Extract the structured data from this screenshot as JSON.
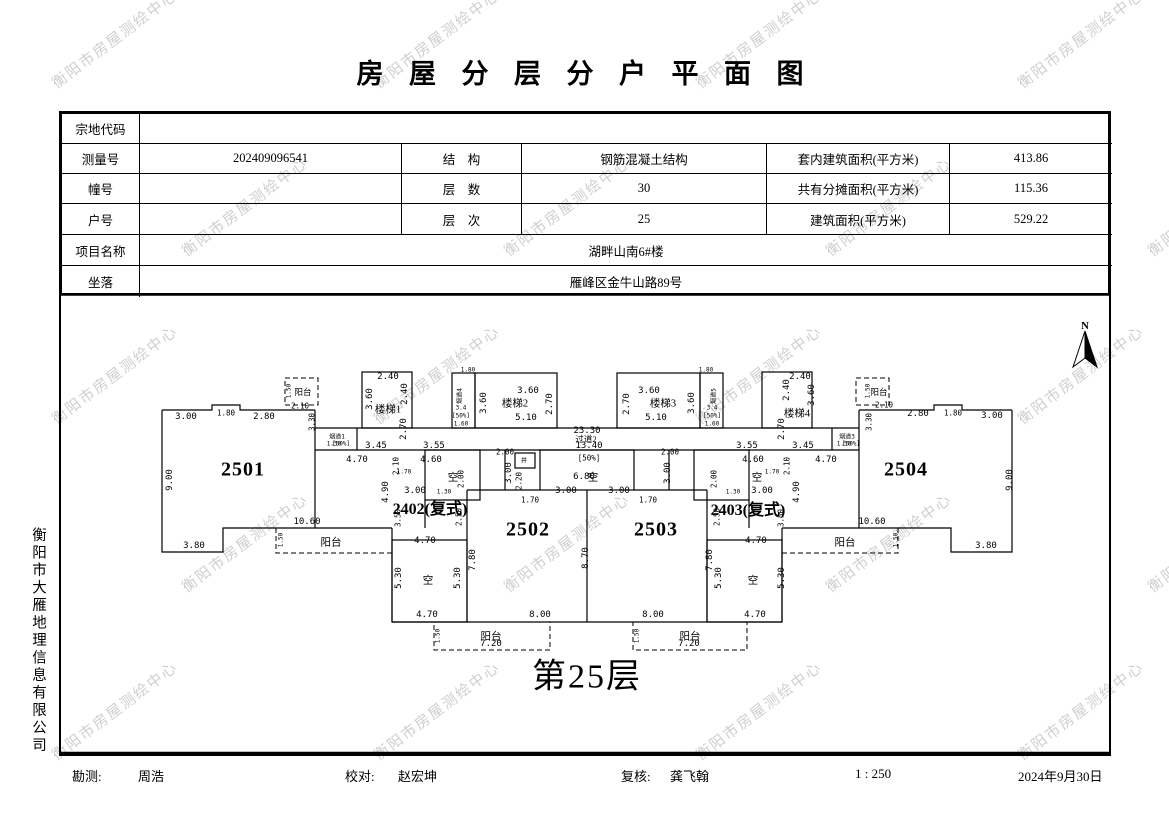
{
  "watermark": {
    "text": "衡阳市房屋测绘中心",
    "color": "#cfcfcf"
  },
  "title": "房 屋 分 层 分 户 平 面 图",
  "info_table": {
    "parcel_code": {
      "label": "宗地代码",
      "value": ""
    },
    "survey_no": {
      "label": "测量号",
      "value": "202409096541"
    },
    "structure": {
      "label": "结　构",
      "value": "钢筋混凝土结构"
    },
    "inner_area": {
      "label": "套内建筑面积(平方米)",
      "value": "413.86"
    },
    "building_no": {
      "label": "幢号",
      "value": ""
    },
    "floors_total": {
      "label": "层　数",
      "value": "30"
    },
    "shared_area": {
      "label": "共有分摊面积(平方米)",
      "value": "115.36"
    },
    "unit_no": {
      "label": "户号",
      "value": ""
    },
    "floor_level": {
      "label": "层　次",
      "value": "25"
    },
    "total_area": {
      "label": "建筑面积(平方米)",
      "value": "529.22"
    },
    "project_name": {
      "label": "项目名称",
      "value": "湖畔山南6#楼"
    },
    "location": {
      "label": "坐落",
      "value": "雁峰区金牛山路89号"
    }
  },
  "plan": {
    "floor_label": "第25层",
    "north_label": "N",
    "labels": [
      {
        "t": "3.00",
        "x": 186,
        "y": 417,
        "c": "dim"
      },
      {
        "t": "1.80",
        "x": 226,
        "y": 413,
        "c": "sm"
      },
      {
        "t": "2.80",
        "x": 264,
        "y": 417,
        "c": "dim"
      },
      {
        "t": "阳台",
        "x": 303,
        "y": 392,
        "c": "room-sm"
      },
      {
        "t": "1.50",
        "x": 289,
        "y": 391,
        "r": -90,
        "c": "tiny"
      },
      {
        "t": "2.10",
        "x": 300,
        "y": 406,
        "c": "sm"
      },
      {
        "t": "3.30",
        "x": 312,
        "y": 422,
        "r": -90,
        "c": "sm"
      },
      {
        "t": "9.00",
        "x": 170,
        "y": 480,
        "r": -90,
        "c": "dim"
      },
      {
        "t": "2501",
        "x": 243,
        "y": 470,
        "c": "unit"
      },
      {
        "t": "3.80",
        "x": 194,
        "y": 546,
        "c": "dim"
      },
      {
        "t": "10.60",
        "x": 307,
        "y": 522,
        "c": "dim"
      },
      {
        "t": "阳台",
        "x": 331,
        "y": 542,
        "c": "room"
      },
      {
        "t": "1.50",
        "x": 281,
        "y": 540,
        "r": -90,
        "c": "tiny"
      },
      {
        "t": "烟道1",
        "x": 337,
        "y": 436,
        "c": "tiny"
      },
      {
        "t": "1.50",
        "x": 334,
        "y": 444,
        "c": "tiny"
      },
      {
        "t": "[50%]",
        "x": 341,
        "y": 444,
        "c": "tiny"
      },
      {
        "t": "3.45",
        "x": 376,
        "y": 446,
        "c": "dim"
      },
      {
        "t": "3.55",
        "x": 434,
        "y": 446,
        "c": "dim"
      },
      {
        "t": "4.70",
        "x": 357,
        "y": 460,
        "c": "dim"
      },
      {
        "t": "4.60",
        "x": 431,
        "y": 460,
        "c": "dim"
      },
      {
        "t": "2.40",
        "x": 388,
        "y": 377,
        "c": "dim"
      },
      {
        "t": "2.40",
        "x": 405,
        "y": 394,
        "r": -90,
        "c": "dim"
      },
      {
        "t": "3.60",
        "x": 370,
        "y": 399,
        "r": -90,
        "c": "dim"
      },
      {
        "t": "楼梯1",
        "x": 388,
        "y": 409,
        "c": "room"
      },
      {
        "t": "2.70",
        "x": 404,
        "y": 429,
        "r": -90,
        "c": "dim"
      },
      {
        "t": "烟道4",
        "x": 459,
        "y": 396,
        "r": -90,
        "c": "tiny"
      },
      {
        "t": "3.4",
        "x": 461,
        "y": 408,
        "c": "tiny"
      },
      {
        "t": "[50%]",
        "x": 461,
        "y": 416,
        "c": "tiny"
      },
      {
        "t": "1.60",
        "x": 461,
        "y": 424,
        "c": "tiny"
      },
      {
        "t": "1.80",
        "x": 468,
        "y": 370,
        "c": "tiny"
      },
      {
        "t": "3.60",
        "x": 484,
        "y": 403,
        "r": -90,
        "c": "dim"
      },
      {
        "t": "3.60",
        "x": 528,
        "y": 391,
        "c": "dim"
      },
      {
        "t": "楼梯2",
        "x": 515,
        "y": 403,
        "c": "room"
      },
      {
        "t": "2.70",
        "x": 550,
        "y": 404,
        "r": -90,
        "c": "dim"
      },
      {
        "t": "5.10",
        "x": 526,
        "y": 418,
        "c": "dim"
      },
      {
        "t": "23.30",
        "x": 587,
        "y": 431,
        "c": "dim"
      },
      {
        "t": "过道2",
        "x": 586,
        "y": 439,
        "c": "room-sm"
      },
      {
        "t": "13.40",
        "x": 589,
        "y": 446,
        "c": "dim"
      },
      {
        "t": "[50%]",
        "x": 589,
        "y": 458,
        "c": "sm"
      },
      {
        "t": "空",
        "x": 593,
        "y": 477,
        "c": "room"
      },
      {
        "t": "6.80",
        "x": 584,
        "y": 477,
        "c": "dim"
      },
      {
        "t": "2.00",
        "x": 505,
        "y": 452,
        "c": "sm"
      },
      {
        "t": "2.00",
        "x": 670,
        "y": 452,
        "c": "sm"
      },
      {
        "t": "井",
        "x": 524,
        "y": 460,
        "c": "tiny"
      },
      {
        "t": "3.00",
        "x": 509,
        "y": 473,
        "r": -90,
        "c": "dim"
      },
      {
        "t": "3.00",
        "x": 668,
        "y": 473,
        "r": -90,
        "c": "dim"
      },
      {
        "t": "2.20",
        "x": 519,
        "y": 481,
        "r": -90,
        "c": "sm"
      },
      {
        "t": "3.00",
        "x": 566,
        "y": 491,
        "c": "dim"
      },
      {
        "t": "3.00",
        "x": 619,
        "y": 491,
        "c": "dim"
      },
      {
        "t": "1.70",
        "x": 530,
        "y": 500,
        "c": "sm"
      },
      {
        "t": "1.70",
        "x": 648,
        "y": 500,
        "c": "sm"
      },
      {
        "t": "3.60",
        "x": 649,
        "y": 391,
        "c": "dim"
      },
      {
        "t": "楼梯3",
        "x": 663,
        "y": 403,
        "c": "room"
      },
      {
        "t": "2.70",
        "x": 627,
        "y": 404,
        "r": -90,
        "c": "dim"
      },
      {
        "t": "5.10",
        "x": 656,
        "y": 418,
        "c": "dim"
      },
      {
        "t": "3.60",
        "x": 692,
        "y": 403,
        "r": -90,
        "c": "dim"
      },
      {
        "t": "烟道5",
        "x": 713,
        "y": 396,
        "r": -90,
        "c": "tiny"
      },
      {
        "t": "3.4",
        "x": 712,
        "y": 408,
        "c": "tiny"
      },
      {
        "t": "[50%]",
        "x": 712,
        "y": 416,
        "c": "tiny"
      },
      {
        "t": "1.60",
        "x": 712,
        "y": 424,
        "c": "tiny"
      },
      {
        "t": "1.80",
        "x": 706,
        "y": 370,
        "c": "tiny"
      },
      {
        "t": "2.40",
        "x": 800,
        "y": 377,
        "c": "dim"
      },
      {
        "t": "2.40",
        "x": 787,
        "y": 390,
        "r": -90,
        "c": "dim"
      },
      {
        "t": "3.60",
        "x": 812,
        "y": 395,
        "r": -90,
        "c": "dim"
      },
      {
        "t": "楼梯4",
        "x": 797,
        "y": 413,
        "c": "room"
      },
      {
        "t": "2.70",
        "x": 782,
        "y": 429,
        "r": -90,
        "c": "dim"
      },
      {
        "t": "3.55",
        "x": 747,
        "y": 446,
        "c": "dim"
      },
      {
        "t": "3.45",
        "x": 803,
        "y": 446,
        "c": "dim"
      },
      {
        "t": "4.60",
        "x": 753,
        "y": 460,
        "c": "dim"
      },
      {
        "t": "4.70",
        "x": 826,
        "y": 460,
        "c": "dim"
      },
      {
        "t": "烟道3",
        "x": 847,
        "y": 436,
        "c": "tiny"
      },
      {
        "t": "1.50",
        "x": 844,
        "y": 444,
        "c": "tiny"
      },
      {
        "t": "[50%]",
        "x": 851,
        "y": 444,
        "c": "tiny"
      },
      {
        "t": "空",
        "x": 453,
        "y": 477,
        "c": "room"
      },
      {
        "t": "3.00",
        "x": 415,
        "y": 491,
        "c": "dim"
      },
      {
        "t": "2402(复式)",
        "x": 430,
        "y": 507,
        "c": "cmplx"
      },
      {
        "t": "2.10",
        "x": 396,
        "y": 466,
        "r": -90,
        "c": "sm"
      },
      {
        "t": "4.90",
        "x": 386,
        "y": 492,
        "r": -90,
        "c": "dim"
      },
      {
        "t": "1.70",
        "x": 404,
        "y": 472,
        "c": "tiny"
      },
      {
        "t": "2.00",
        "x": 461,
        "y": 479,
        "r": -90,
        "c": "sm"
      },
      {
        "t": "1.30",
        "x": 444,
        "y": 492,
        "c": "tiny"
      },
      {
        "t": "3.50",
        "x": 398,
        "y": 518,
        "r": -90,
        "c": "sm"
      },
      {
        "t": "2.50",
        "x": 459,
        "y": 517,
        "r": -90,
        "c": "sm"
      },
      {
        "t": "4.70",
        "x": 425,
        "y": 541,
        "c": "dim"
      },
      {
        "t": "5.30",
        "x": 399,
        "y": 578,
        "r": -90,
        "c": "dim"
      },
      {
        "t": "空",
        "x": 428,
        "y": 580,
        "c": "room"
      },
      {
        "t": "5.30",
        "x": 458,
        "y": 578,
        "r": -90,
        "c": "dim"
      },
      {
        "t": "4.70",
        "x": 427,
        "y": 615,
        "c": "dim"
      },
      {
        "t": "7.80",
        "x": 473,
        "y": 560,
        "r": -90,
        "c": "dim"
      },
      {
        "t": "2502",
        "x": 528,
        "y": 530,
        "c": "unit"
      },
      {
        "t": "8.00",
        "x": 540,
        "y": 615,
        "c": "dim"
      },
      {
        "t": "8.70",
        "x": 586,
        "y": 558,
        "r": -90,
        "c": "dim"
      },
      {
        "t": "2503",
        "x": 656,
        "y": 530,
        "c": "unit"
      },
      {
        "t": "8.00",
        "x": 653,
        "y": 615,
        "c": "dim"
      },
      {
        "t": "7.80",
        "x": 710,
        "y": 560,
        "r": -90,
        "c": "dim"
      },
      {
        "t": "空",
        "x": 757,
        "y": 477,
        "c": "room"
      },
      {
        "t": "3.00",
        "x": 762,
        "y": 491,
        "c": "dim"
      },
      {
        "t": "2403(复式)",
        "x": 748,
        "y": 508,
        "c": "cmplx"
      },
      {
        "t": "2.10",
        "x": 787,
        "y": 466,
        "r": -90,
        "c": "sm"
      },
      {
        "t": "4.90",
        "x": 797,
        "y": 492,
        "r": -90,
        "c": "dim"
      },
      {
        "t": "1.70",
        "x": 772,
        "y": 472,
        "c": "tiny"
      },
      {
        "t": "2.00",
        "x": 714,
        "y": 479,
        "r": -90,
        "c": "sm"
      },
      {
        "t": "1.30",
        "x": 733,
        "y": 492,
        "c": "tiny"
      },
      {
        "t": "2.50",
        "x": 717,
        "y": 517,
        "r": -90,
        "c": "sm"
      },
      {
        "t": "3.50",
        "x": 781,
        "y": 518,
        "r": -90,
        "c": "sm"
      },
      {
        "t": "4.70",
        "x": 756,
        "y": 541,
        "c": "dim"
      },
      {
        "t": "5.30",
        "x": 719,
        "y": 578,
        "r": -90,
        "c": "dim"
      },
      {
        "t": "空",
        "x": 753,
        "y": 580,
        "c": "room"
      },
      {
        "t": "5.30",
        "x": 782,
        "y": 578,
        "r": -90,
        "c": "dim"
      },
      {
        "t": "4.70",
        "x": 755,
        "y": 615,
        "c": "dim"
      },
      {
        "t": "2504",
        "x": 906,
        "y": 470,
        "c": "unit"
      },
      {
        "t": "阳台",
        "x": 879,
        "y": 392,
        "c": "room-sm"
      },
      {
        "t": "1.50",
        "x": 868,
        "y": 391,
        "r": -90,
        "c": "tiny"
      },
      {
        "t": "2.10",
        "x": 884,
        "y": 405,
        "c": "sm"
      },
      {
        "t": "2.80",
        "x": 918,
        "y": 414,
        "c": "dim"
      },
      {
        "t": "1.80",
        "x": 953,
        "y": 413,
        "c": "sm"
      },
      {
        "t": "3.00",
        "x": 992,
        "y": 416,
        "c": "dim"
      },
      {
        "t": "3.30",
        "x": 869,
        "y": 422,
        "r": -90,
        "c": "sm"
      },
      {
        "t": "9.00",
        "x": 1010,
        "y": 480,
        "r": -90,
        "c": "dim"
      },
      {
        "t": "10.60",
        "x": 872,
        "y": 522,
        "c": "dim"
      },
      {
        "t": "阳台",
        "x": 845,
        "y": 542,
        "c": "room"
      },
      {
        "t": "3.80",
        "x": 986,
        "y": 546,
        "c": "dim"
      },
      {
        "t": "1.50",
        "x": 896,
        "y": 540,
        "r": -90,
        "c": "tiny"
      },
      {
        "t": "阳台",
        "x": 491,
        "y": 636,
        "c": "room"
      },
      {
        "t": "7.20",
        "x": 491,
        "y": 644,
        "c": "dim"
      },
      {
        "t": "1.50",
        "x": 438,
        "y": 636,
        "r": -90,
        "c": "tiny"
      },
      {
        "t": "阳台",
        "x": 690,
        "y": 636,
        "c": "room"
      },
      {
        "t": "7.20",
        "x": 689,
        "y": 644,
        "c": "dim"
      },
      {
        "t": "1.50",
        "x": 637,
        "y": 636,
        "r": -90,
        "c": "tiny"
      }
    ]
  },
  "sidebar_company": "衡阳市大雁地理信息有限公司",
  "footer": {
    "survey_label": "勘测:",
    "survey_value": "周浩",
    "proof_label": "校对:",
    "proof_value": "赵宏坤",
    "review_label": "复核:",
    "review_value": "龚飞翰",
    "scale": "1 : 250",
    "date": "2024年9月30日"
  }
}
